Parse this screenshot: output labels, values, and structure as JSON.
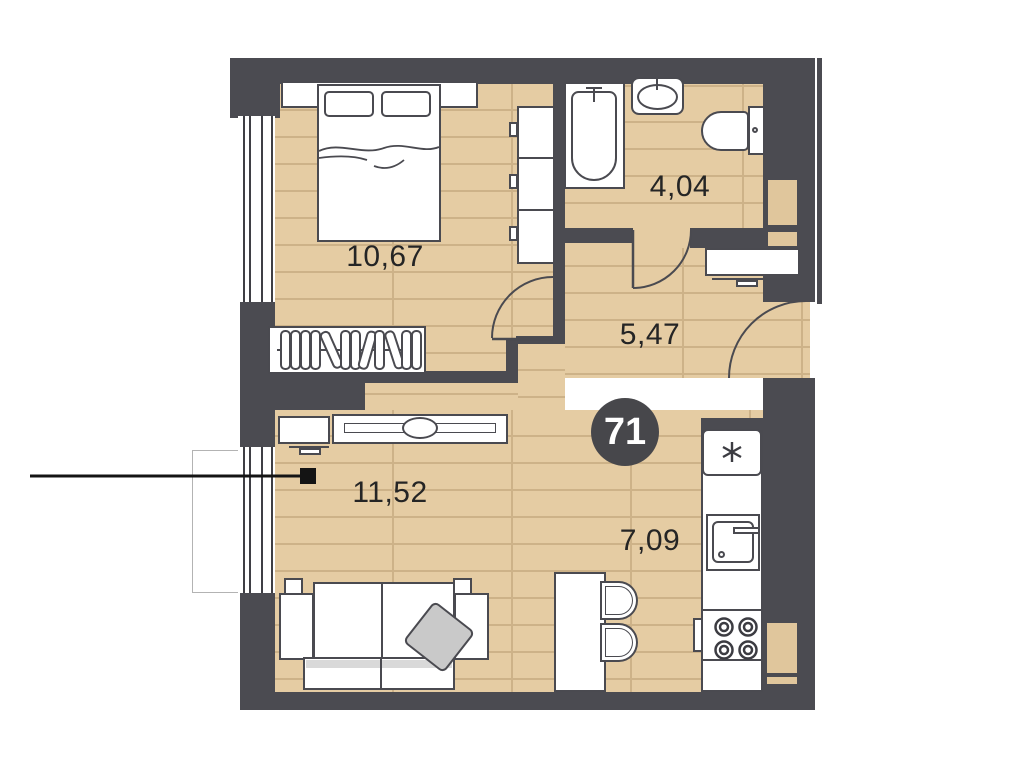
{
  "plan": {
    "unit_number": "71",
    "type": "apartment-floor-plan",
    "rooms": [
      {
        "id": "bedroom",
        "area": "10,67"
      },
      {
        "id": "bathroom",
        "area": "4,04"
      },
      {
        "id": "hallway",
        "area": "5,47"
      },
      {
        "id": "kitchen",
        "area": "7,09"
      },
      {
        "id": "living-room",
        "area": "11,52"
      }
    ]
  },
  "labels": {
    "bedroom": "10,67",
    "bathroom": "4,04",
    "hallway": "5,47",
    "kitchen": "7,09",
    "living": "11,52",
    "unit": "71"
  },
  "colors": {
    "wall": "#4b4b51",
    "floor": "#e5cca3",
    "plank_line": "#cdb288",
    "badge": "#47474b",
    "furniture_outline": "#4a4a50",
    "pillow": "#c9c9c9",
    "label_text": "#252525"
  },
  "icons": {
    "freezer": "snowflake-icon",
    "stove": "burner-rings-icon",
    "wardrobe": "clothes-hangers-icon",
    "doors": "door-swing-arc-icon",
    "entry_marker": "entry-marker-icon"
  }
}
